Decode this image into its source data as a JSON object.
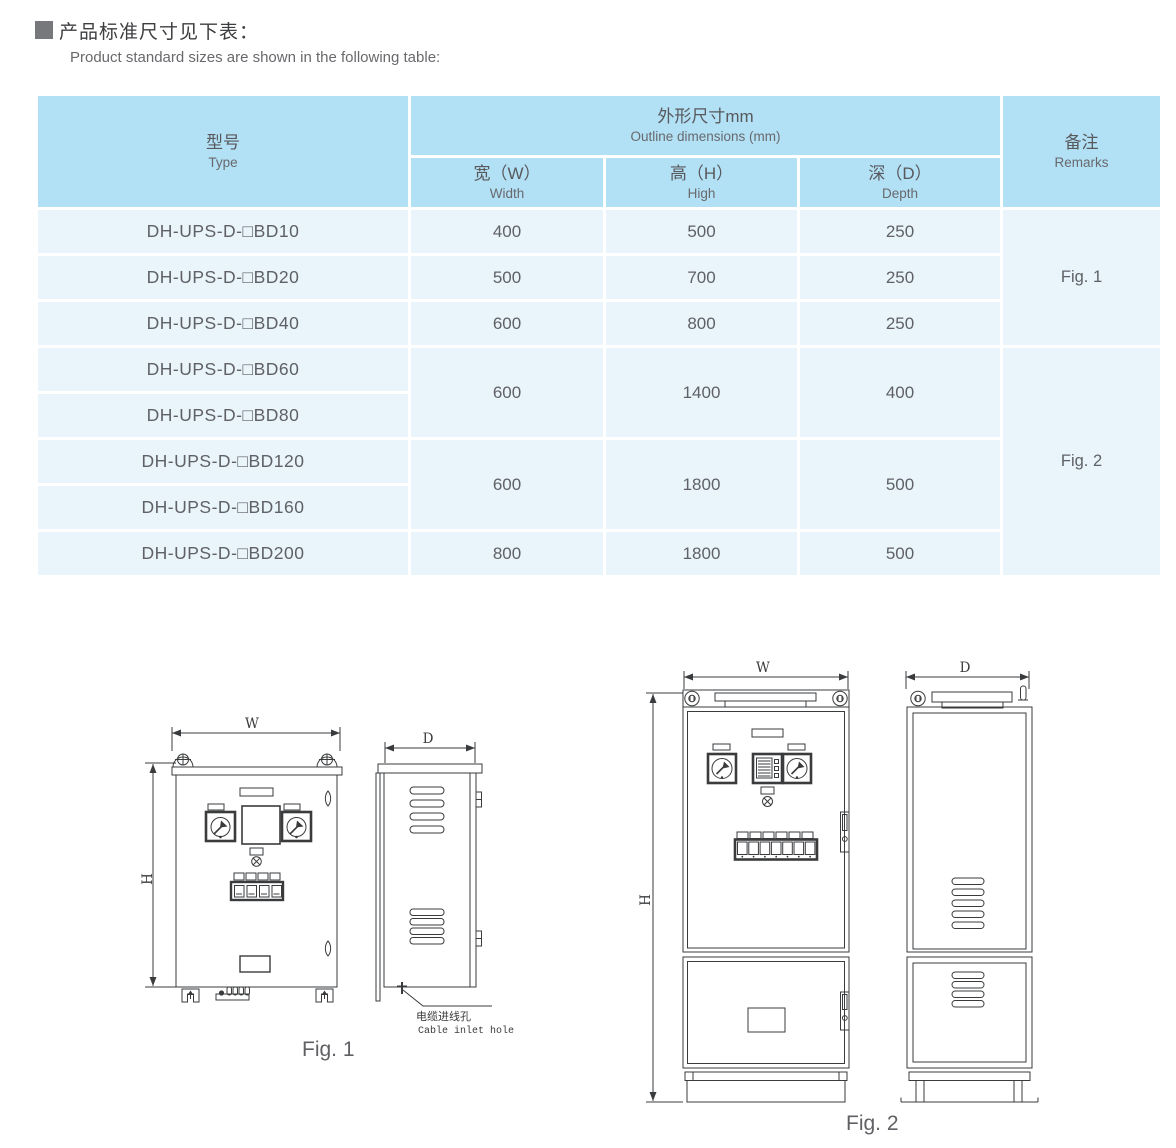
{
  "header": {
    "bullet": "■",
    "title_cn": "产品标准尺寸见下表：",
    "subtitle_en": "Product standard sizes are shown in the following table:"
  },
  "table": {
    "col_type": {
      "cn": "型号",
      "en": "Type"
    },
    "col_outline": {
      "cn": "外形尺寸mm",
      "en": "Outline dimensions (mm)"
    },
    "col_width": {
      "cn": "宽（W）",
      "en": "Width"
    },
    "col_high": {
      "cn": "高（H）",
      "en": "High"
    },
    "col_depth": {
      "cn": "深（D）",
      "en": "Depth"
    },
    "col_remarks": {
      "cn": "备注",
      "en": "Remarks"
    },
    "rows": [
      {
        "type": "DH-UPS-D-□BD10",
        "w": "400",
        "h": "500",
        "d": "250"
      },
      {
        "type": "DH-UPS-D-□BD20",
        "w": "500",
        "h": "700",
        "d": "250"
      },
      {
        "type": "DH-UPS-D-□BD40",
        "w": "600",
        "h": "800",
        "d": "250"
      },
      {
        "type": "DH-UPS-D-□BD60"
      },
      {
        "type": "DH-UPS-D-□BD80"
      },
      {
        "type": "DH-UPS-D-□BD120"
      },
      {
        "type": "DH-UPS-D-□BD160"
      },
      {
        "type": "DH-UPS-D-□BD200",
        "w": "800",
        "h": "1800",
        "d": "500"
      }
    ],
    "merged_60_80": {
      "w": "600",
      "h": "1400",
      "d": "400"
    },
    "merged_120_160": {
      "w": "600",
      "h": "1800",
      "d": "500"
    },
    "remark_fig1": "Fig. 1",
    "remark_fig2": "Fig. 2"
  },
  "figures": {
    "fig1": {
      "caption": "Fig. 1",
      "dim_w": "W",
      "dim_h": "H",
      "dim_d": "D",
      "cable_inlet_cn": "电缆进线孔",
      "cable_inlet_en": "Cable inlet hole"
    },
    "fig2": {
      "caption": "Fig. 2",
      "dim_w": "W",
      "dim_h": "H",
      "dim_d": "D"
    }
  },
  "colors": {
    "table_header_bg": "#b2e0f5",
    "table_row_bg": "#e9f4fb",
    "grid_line": "#ffffff",
    "table_text": "#5f6166",
    "title_text": "#3d3e40",
    "drawing_line": "#3a3b3c"
  }
}
